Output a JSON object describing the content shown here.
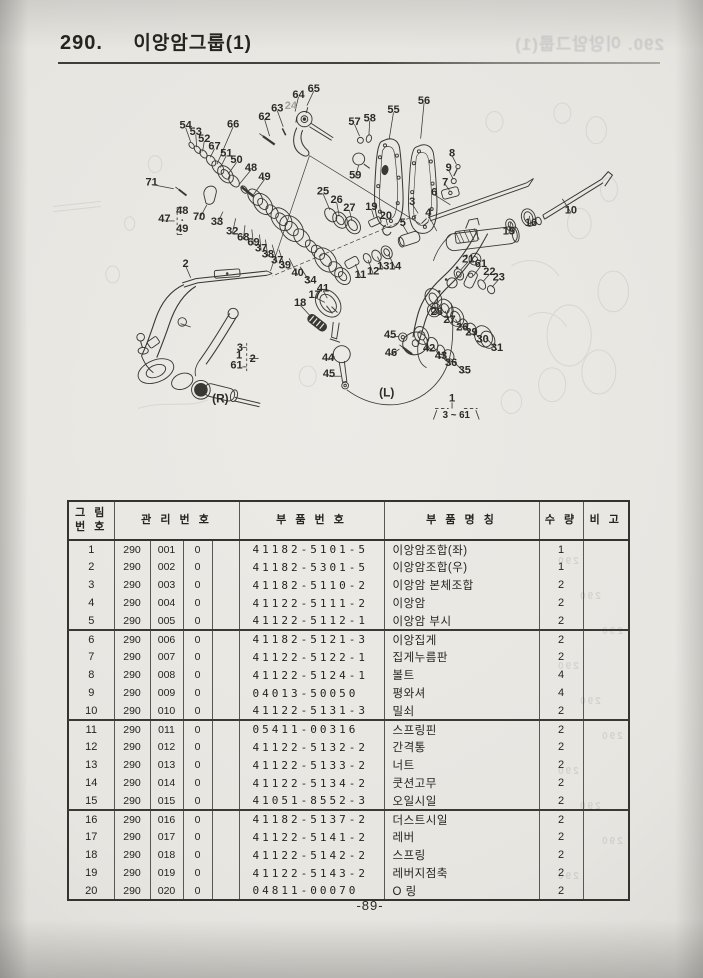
{
  "page": {
    "section_number": "290.",
    "title": "이앙암그룹(1)",
    "page_number": "-89-"
  },
  "bleed": {
    "title_ghost": "290. 이앙암그룹(1)",
    "table_ghost": "290"
  },
  "diagram": {
    "callouts": [
      [
        "65",
        307,
        91,
        299,
        111
      ],
      [
        "64",
        289,
        98,
        285,
        118
      ],
      [
        "63",
        264,
        114,
        271,
        136
      ],
      [
        "24",
        280,
        111,
        null,
        null,
        true
      ],
      [
        "62",
        249,
        124,
        255,
        147
      ],
      [
        "57",
        355,
        130,
        361,
        147
      ],
      [
        "58",
        373,
        126,
        372,
        146
      ],
      [
        "55",
        401,
        116,
        396,
        150
      ],
      [
        "56",
        437,
        105,
        433,
        150
      ],
      [
        "59",
        356,
        193,
        360,
        181
      ],
      [
        "8",
        470,
        167,
        475,
        180
      ],
      [
        "9",
        466,
        184,
        471,
        197
      ],
      [
        "7",
        462,
        201,
        467,
        211
      ],
      [
        "6",
        449,
        213,
        468,
        228
      ],
      [
        "71",
        116,
        201,
        142,
        209
      ],
      [
        "54",
        156,
        134,
        162,
        154
      ],
      [
        "53",
        168,
        142,
        169,
        160
      ],
      [
        "52",
        178,
        150,
        176,
        165
      ],
      [
        "66",
        212,
        133,
        193,
        180
      ],
      [
        "67",
        190,
        159,
        185,
        172
      ],
      [
        "51",
        204,
        167,
        197,
        184
      ],
      [
        "50",
        216,
        175,
        206,
        192
      ],
      [
        "48",
        233,
        184,
        219,
        204
      ],
      [
        "49",
        249,
        195,
        236,
        216
      ],
      [
        "25",
        318,
        212,
        326,
        234
      ],
      [
        "26",
        334,
        222,
        337,
        241
      ],
      [
        "27",
        349,
        231,
        352,
        247
      ],
      [
        "19",
        375,
        230,
        378,
        243
      ],
      [
        "20",
        392,
        241,
        394,
        252
      ],
      [
        "3",
        423,
        224,
        430,
        238
      ],
      [
        "4",
        442,
        237,
        452,
        259
      ],
      [
        "5",
        412,
        249,
        418,
        262
      ],
      [
        "15",
        537,
        259,
        539,
        249
      ],
      [
        "16",
        563,
        249,
        561,
        241
      ],
      [
        "10",
        610,
        234,
        600,
        221
      ],
      [
        "47",
        131,
        244,
        143,
        247
      ],
      [
        "48",
        152,
        235,
        null,
        null
      ],
      [
        "49",
        152,
        256,
        null,
        null
      ],
      [
        "70",
        172,
        242,
        181,
        228
      ],
      [
        "33",
        193,
        248,
        200,
        236
      ],
      [
        "32",
        211,
        259,
        215,
        244
      ],
      [
        "68",
        224,
        266,
        226,
        252
      ],
      [
        "69",
        236,
        272,
        234,
        257
      ],
      [
        "37",
        245,
        279,
        243,
        263
      ],
      [
        "38",
        253,
        286,
        250,
        269
      ],
      [
        "37",
        264,
        293,
        258,
        275
      ],
      [
        "39",
        273,
        299,
        266,
        281
      ],
      [
        "40",
        288,
        308,
        278,
        291
      ],
      [
        "34",
        303,
        317,
        291,
        301
      ],
      [
        "41",
        318,
        326,
        323,
        338
      ],
      [
        "2",
        156,
        297,
        162,
        314
      ],
      [
        "17",
        308,
        334,
        320,
        343
      ],
      [
        "18",
        291,
        343,
        302,
        358
      ],
      [
        "11",
        362,
        310,
        356,
        298
      ],
      [
        "12",
        377,
        306,
        371,
        293
      ],
      [
        "13",
        389,
        300,
        382,
        289
      ],
      [
        "14",
        403,
        300,
        395,
        286
      ],
      [
        "21",
        489,
        292,
        480,
        305
      ],
      [
        "61",
        504,
        297,
        495,
        312
      ],
      [
        "22",
        514,
        307,
        507,
        318
      ],
      [
        "23",
        525,
        313,
        517,
        325
      ],
      [
        "28",
        452,
        354,
        449,
        343
      ],
      [
        "27",
        467,
        363,
        462,
        353
      ],
      [
        "26",
        482,
        372,
        474,
        363
      ],
      [
        "29",
        493,
        378,
        485,
        370
      ],
      [
        "30",
        506,
        386,
        495,
        377
      ],
      [
        "31",
        523,
        396,
        510,
        385
      ],
      [
        "42",
        443,
        397,
        436,
        387
      ],
      [
        "43",
        457,
        406,
        448,
        395
      ],
      [
        "36",
        469,
        414,
        458,
        402
      ],
      [
        "35",
        485,
        423,
        468,
        409
      ],
      [
        "45",
        397,
        381,
        407,
        383
      ],
      [
        "46",
        398,
        402,
        408,
        398
      ],
      [
        "44",
        324,
        408,
        332,
        407
      ],
      [
        "45",
        325,
        427,
        339,
        430
      ],
      [
        "3",
        220,
        396,
        null,
        null
      ],
      [
        "1",
        219,
        405,
        null,
        null
      ],
      [
        "61",
        216,
        417,
        null,
        null
      ],
      [
        "2",
        235,
        409,
        null,
        null
      ],
      [
        "1",
        470,
        456,
        null,
        null
      ],
      [
        "(R)",
        197,
        457,
        null,
        null
      ],
      [
        "(L)",
        393,
        450,
        null,
        null
      ],
      [
        "3 ~ 61",
        475,
        475,
        null,
        null
      ]
    ]
  },
  "table": {
    "headers": {
      "fig_no_line1": "그 림",
      "fig_no_line2": "번 호",
      "mgmt_no": "관 리 번 호",
      "part_no": "부 품 번 호",
      "part_name": "부 품 명 칭",
      "qty": "수 량",
      "remarks": "비 고"
    },
    "rows": [
      [
        "1",
        "290",
        "001",
        "0",
        "41182-5101-5",
        "이앙암조합(좌)",
        "1"
      ],
      [
        "2",
        "290",
        "002",
        "0",
        "41182-5301-5",
        "이앙암조합(우)",
        "1"
      ],
      [
        "3",
        "290",
        "003",
        "0",
        "41182-5110-2",
        "이앙암 본체조합",
        "2"
      ],
      [
        "4",
        "290",
        "004",
        "0",
        "41122-5111-2",
        "이앙암",
        "2"
      ],
      [
        "5",
        "290",
        "005",
        "0",
        "41122-5112-1",
        "이앙암 부시",
        "2"
      ],
      [
        "6",
        "290",
        "006",
        "0",
        "41182-5121-3",
        "이앙집게",
        "2"
      ],
      [
        "7",
        "290",
        "007",
        "0",
        "41122-5122-1",
        "집게누름판",
        "2"
      ],
      [
        "8",
        "290",
        "008",
        "0",
        "41122-5124-1",
        "볼트",
        "4"
      ],
      [
        "9",
        "290",
        "009",
        "0",
        "04013-50050",
        "평와셔",
        "4"
      ],
      [
        "10",
        "290",
        "010",
        "0",
        "41122-5131-3",
        "밀쇠",
        "2"
      ],
      [
        "11",
        "290",
        "011",
        "0",
        "05411-00316",
        "스프링핀",
        "2"
      ],
      [
        "12",
        "290",
        "012",
        "0",
        "41122-5132-2",
        "간격통",
        "2"
      ],
      [
        "13",
        "290",
        "013",
        "0",
        "41122-5133-2",
        "너트",
        "2"
      ],
      [
        "14",
        "290",
        "014",
        "0",
        "41122-5134-2",
        "쿳션고무",
        "2"
      ],
      [
        "15",
        "290",
        "015",
        "0",
        "41051-8552-3",
        "오일시일",
        "2"
      ],
      [
        "16",
        "290",
        "016",
        "0",
        "41182-5137-2",
        "더스트시일",
        "2"
      ],
      [
        "17",
        "290",
        "017",
        "0",
        "41122-5141-2",
        "레버",
        "2"
      ],
      [
        "18",
        "290",
        "018",
        "0",
        "41122-5142-2",
        "스프링",
        "2"
      ],
      [
        "19",
        "290",
        "019",
        "0",
        "41122-5143-2",
        "레버지점축",
        "2"
      ],
      [
        "20",
        "290",
        "020",
        "0",
        "04811-00070",
        "O 링",
        "2"
      ]
    ]
  }
}
